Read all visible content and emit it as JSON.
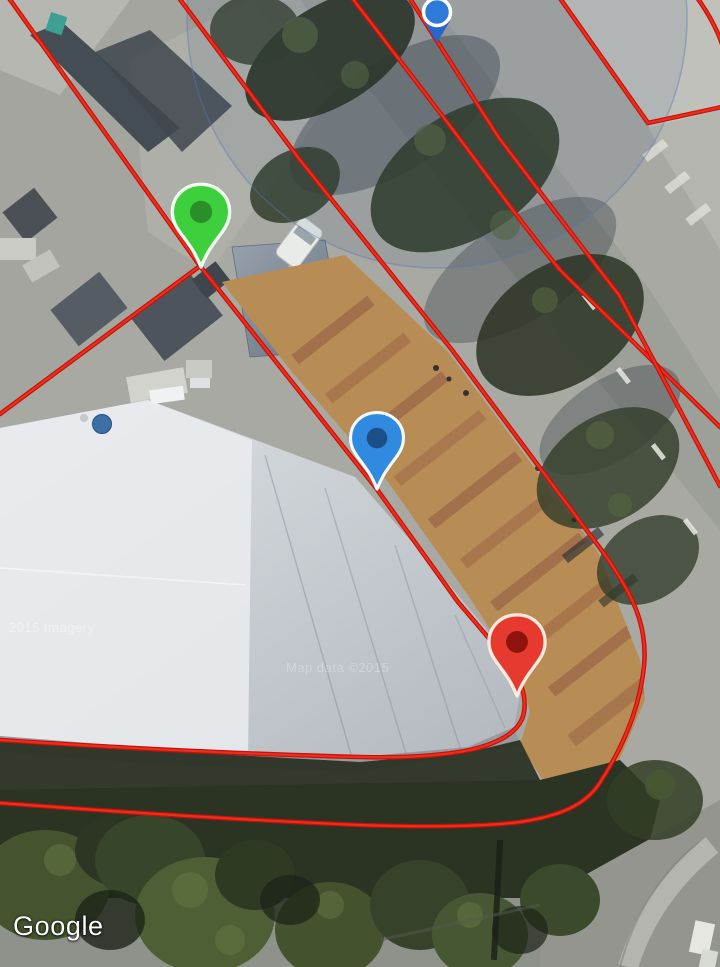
{
  "map": {
    "provider_logo": "Google",
    "watermark_left": "2015 Imagery",
    "watermark_center": "Map data ©2015",
    "overlay": {
      "edge_color": "#c21309",
      "line_color": "#ee2d1d",
      "boundaries": [
        {
          "id": "parcel-edge-northwest",
          "d": "M6,-6 L200,266"
        },
        {
          "id": "parcel-edge-southwest",
          "d": "M200,266 L0,414"
        },
        {
          "id": "parcel-edge-main",
          "d": "M200,266 L376,488 L458,602 L504,656 C520,678 527,695 524,712 C521,731 500,743 470,750 C440,756 400,758 360,757 C240,754 120,748 0,740"
        },
        {
          "id": "market-east-boundary",
          "d": "M176,-6 L300,160 L380,260 L452,350 L540,468 L600,548 C632,592 648,625 644,666 C640,706 624,746 599,784 C585,805 560,816 520,822 C480,827 420,827 360,825 C240,820 120,812 0,803"
        },
        {
          "id": "road-boundary-west",
          "d": "M349,-6 L444,118 C480,165 520,222 560,270 L720,427"
        },
        {
          "id": "road-boundary-east",
          "d": "M407,-6 L499,138 C540,192 580,245 619,295 L720,486"
        },
        {
          "id": "curb-corner-line",
          "d": "M557,-6 L648,123 L722,107"
        },
        {
          "id": "top-right-corner-line",
          "d": "M696,-4 C706,10 716,26 722,44"
        }
      ]
    },
    "pins": [
      {
        "id": "green-map-pin",
        "x": 201,
        "y": 267,
        "scale": 1.06,
        "fill": "#3ed03c",
        "inner": "#2a8f28",
        "outline": "#edffee"
      },
      {
        "id": "blue-map-pin",
        "x": 377,
        "y": 489,
        "scale": 0.98,
        "fill": "#2f8ae0",
        "inner": "#1d4f87",
        "outline": "#f4f9ff"
      },
      {
        "id": "red-map-pin",
        "x": 517,
        "y": 696,
        "scale": 1.04,
        "fill": "#e63a30",
        "inner": "#8e130d",
        "outline": "#ffe9da"
      }
    ],
    "location_marker": {
      "x": 437,
      "y": 12,
      "radius": 13.5,
      "fill": "#2f7ad8",
      "pointer_fill": "#2a66c8",
      "ring": "#ffffff"
    },
    "accuracy_circle": {
      "cx": 437,
      "cy": 18,
      "r": 250,
      "fill": "rgba(48,78,128,0.10)",
      "stroke": "rgba(88,120,180,0.42)"
    }
  }
}
